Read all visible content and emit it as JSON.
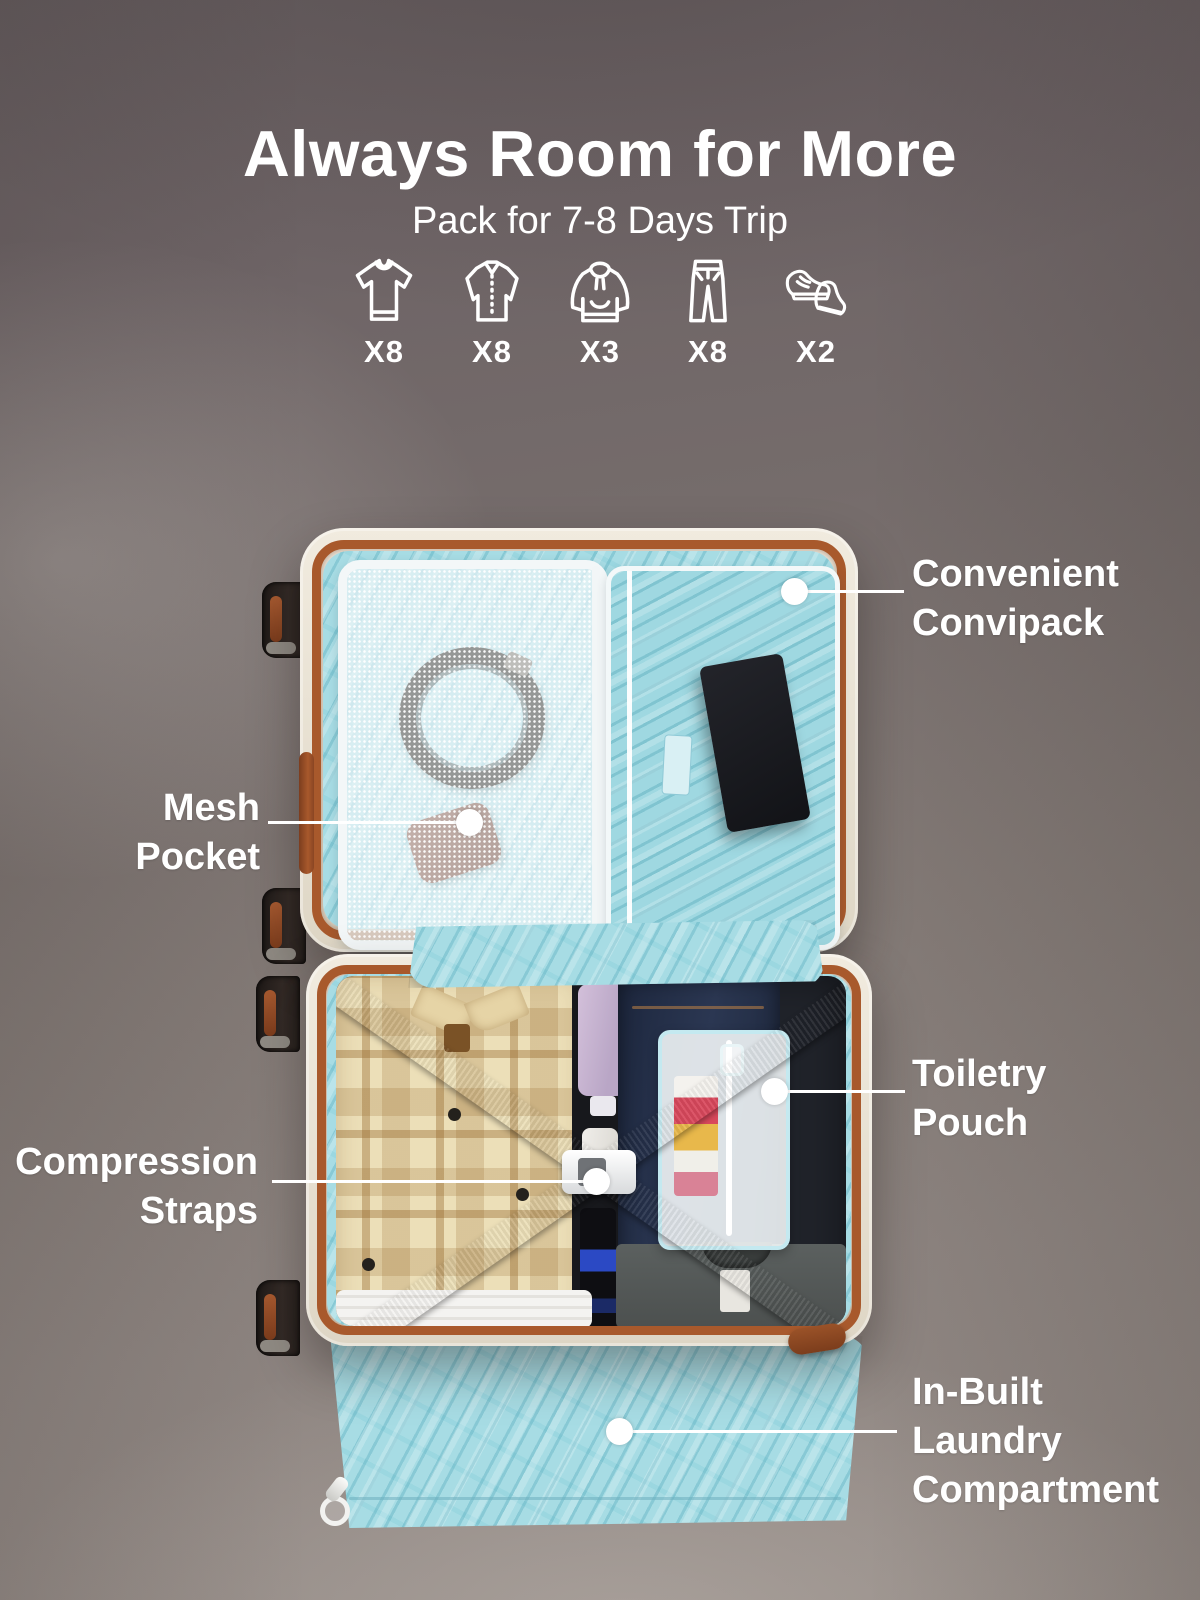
{
  "header": {
    "title": "Always Room for More",
    "subtitle": "Pack for 7-8 Days Trip"
  },
  "packing_items": [
    {
      "icon": "tshirt-icon",
      "count": "X8"
    },
    {
      "icon": "shirt-icon",
      "count": "X8"
    },
    {
      "icon": "hoodie-icon",
      "count": "X3"
    },
    {
      "icon": "pants-icon",
      "count": "X8"
    },
    {
      "icon": "shoes-icon",
      "count": "X2"
    }
  ],
  "callouts": {
    "convipack": {
      "text": "Convenient\nConvipack"
    },
    "mesh": {
      "text": "Mesh\nPocket"
    },
    "straps": {
      "text": "Compression\nStraps"
    },
    "toiletry": {
      "text": "Toiletry\nPouch"
    },
    "laundry": {
      "text": "In-Built\nLaundry\nCompartment"
    }
  },
  "colors": {
    "text": "#ffffff",
    "lining_blue": "#a7dce4",
    "shell_cream": "#ece5d6",
    "trim_brown": "#a8592c",
    "strap_gray": "#6b6d70"
  }
}
